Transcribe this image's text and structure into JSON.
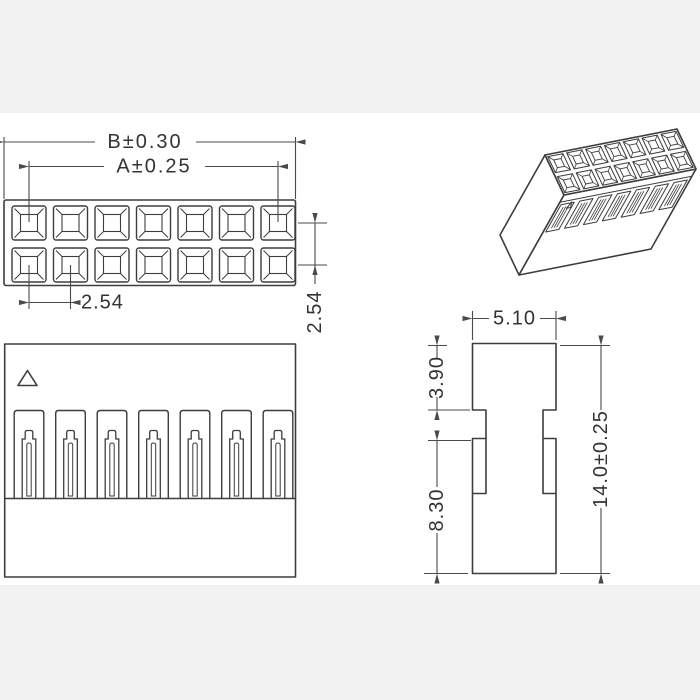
{
  "background": {
    "page": "#f2f2f2",
    "canvas": "#ffffff"
  },
  "colors": {
    "line": "#3d3d3d",
    "dim_line": "#4a4a4a",
    "text": "#333333"
  },
  "top_view": {
    "pin_rows": 2,
    "pin_cols": 7,
    "labels": {
      "width_overall": "B±0.30",
      "width_pins": "A±0.25",
      "pitch_horizontal": "2.54",
      "pitch_vertical": "2.54"
    }
  },
  "front_view": {
    "slot_count": 7
  },
  "side_view": {
    "labels": {
      "width": "5.10",
      "upper_height": "3.90",
      "lower_height": "8.30",
      "overall_height": "14.0±0.25"
    }
  },
  "iso_view": {
    "pin_rows": 2,
    "pin_cols": 7,
    "slot_count": 7
  }
}
